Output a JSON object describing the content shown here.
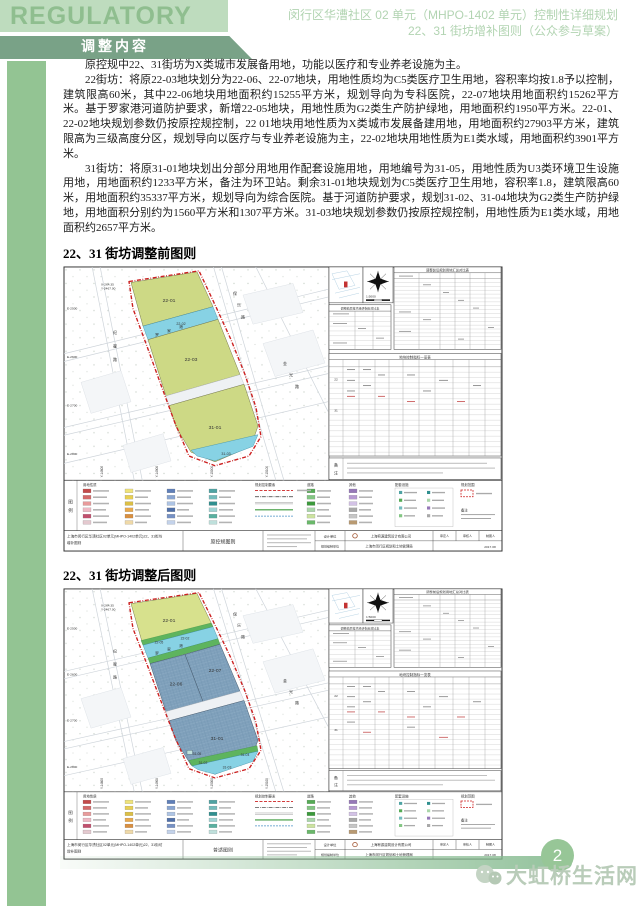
{
  "page": {
    "number": "2",
    "colors": {
      "accent_green_light": "#bedcbe",
      "accent_green_dark": "#79a287",
      "sidebar_green": "#93c493",
      "reserve_parcel_yellow": "#cdd985",
      "water_cyan": "#87d2e4",
      "medical_parcel_blue": "#7fa0bb",
      "protective_green": "#5eb45e",
      "boundary_red": "#cc2020"
    }
  },
  "header": {
    "logo_text": "REGULATORY PLAN",
    "title_line1": "闵行区华漕社区 02 单元（MHPO-1402 单元）控制性详细规划",
    "title_line2": "22、31 街坊增补图则（公众参与草案）",
    "section_banner": "调整内容"
  },
  "body": {
    "paragraphs": [
      "原控规中22、31街坊为X类城市发展备用地，功能以医疗和专业养老设施为主。",
      "22街坊：将原22-03地块划分为22-06、22-07地块，用地性质均为C5类医疗卫生用地，容积率均按1.8予以控制，建筑限高60米，其中22-06地块用地面积约15255平方米，规划导向为专科医院，22-07地块用地面积约15262平方米。基于罗家港河道防护要求，新增22-05地块，用地性质为G2类生产防护绿地，用地面积约1950平方米。22-01、22-02地块规划参数仍按原控规控制，22 01地块用地性质为X类城市发展备建用地，用地面积约27903平方米，建筑限高为三级高度分区，规划导向以医疗与专业养老设施为主，22-02地块用地性质为E1类水域，用地面积约3901平方米。",
      "31街坊：将原31-01地块划出分部分用地用作配套设施用地，用地编号为31-05，用地性质为U3类环境卫生设施用地，用地面积约1233平方米，备注为环卫站。剩余31-01地块规划为C5类医疗卫生用地，容积率1.8，建筑限高60米，用地面积约35337平方米，规划导向为综合医院。基于河道防护要求，规划31-02、31-04地块为G2类生产防护绿地，用地面积分别约为1560平方米和1307平方米。31-03地块规划参数仍按原控规控制，用地性质为E1类水域，用地面积约2657平方米。"
    ]
  },
  "figure_common": {
    "legend_label_chars": [
      "图",
      "例"
    ],
    "note_label_chars": [
      "备",
      "注"
    ],
    "scale": "1:5000",
    "tables": {
      "summary": "调整前后规划用地汇总对比表",
      "economic": "调整前后技术经济指标对比表",
      "control": "地块控制指标一览表",
      "row_groups": [
        "22",
        "31"
      ]
    },
    "legend_groups": [
      "用地性质",
      "规划控制要素",
      "道路",
      "其他",
      "配套设施",
      "规划范围",
      "备注"
    ],
    "palette": [
      "#c44a4a",
      "#d46a6a",
      "#e89b9b",
      "#efb9c4",
      "#c2506e",
      "#e4c9cf",
      "#efe37a",
      "#e8cf52",
      "#dcbf45",
      "#e9a94d",
      "#d98f3f",
      "#efd9a8",
      "#5f7fb8",
      "#8aa6d2",
      "#aec4e4",
      "#4f6fa8",
      "#7691c4",
      "#c3d2ea",
      "#4fa3a3",
      "#73bcbc",
      "#2f8f8f",
      "#9fd4d4",
      "#58b0a0",
      "#bfe0dc",
      "#55ab55",
      "#83c683",
      "#3c9a3c",
      "#aad6aa",
      "#cce3a0",
      "#6ab86a",
      "#9678b8",
      "#b79ad2",
      "#d3c2e6",
      "#a8a8a8",
      "#c6c6c6",
      "#b99a72"
    ],
    "facility_colors": [
      "#4fa3a3",
      "#55ab55",
      "#73bcbc",
      "#83c683",
      "#2f8f8f",
      "#aad6aa",
      "#9678b8",
      "#a8a8a8"
    ],
    "map_annotations": {
      "river_chars": [
        "罗",
        "家",
        "港"
      ],
      "road1_chars": [
        "纪",
        "翟",
        "路"
      ],
      "road2_chars": [
        "保",
        "乐",
        "路"
      ],
      "road3_chars": [
        "金",
        "光",
        "路"
      ],
      "corner_coords": [
        "X-264.35",
        "Y-2467.00"
      ],
      "ticks_left": [
        "E-2500",
        "E-2600",
        "E-2700",
        "E-2800"
      ],
      "ticks_bottom": [
        "Y-14800",
        "Y-14900",
        "Y-15000",
        "Y-15100"
      ]
    },
    "titleblock": {
      "project_line1": "上海市闵行区华漕社区02单元(MHPO-1402单元)22、31街坊",
      "project_line2": "增补图则",
      "design_label": "设计单位",
      "compile_label": "规划编制单位",
      "design_company": "上海宥源建筑设计有限公司",
      "compile_org": "上海市闵行区规划和土地管理局",
      "signers": [
        "审定人",
        "审核人",
        "制图人"
      ],
      "date": "2017.08"
    }
  },
  "figures": [
    {
      "heading": "22、31 街坊调整前图则",
      "sheet_name": "原控规图则",
      "labels": {
        "a": "22-01",
        "river": "22-02",
        "b": "22-03",
        "c": "31-01",
        "c_river": "31-03"
      }
    },
    {
      "heading": "22、31 街坊调整后图则",
      "sheet_name": "普适图则",
      "labels": {
        "a": "22-01",
        "river": "22-02",
        "g1": "22-05",
        "b1": "22-06",
        "b2": "22-07",
        "c": "31-01",
        "g2": "31-02",
        "c_river": "31-03",
        "g3": "31-04",
        "u": "31-05"
      }
    }
  ],
  "watermark": {
    "text": "大虹桥生活网"
  }
}
